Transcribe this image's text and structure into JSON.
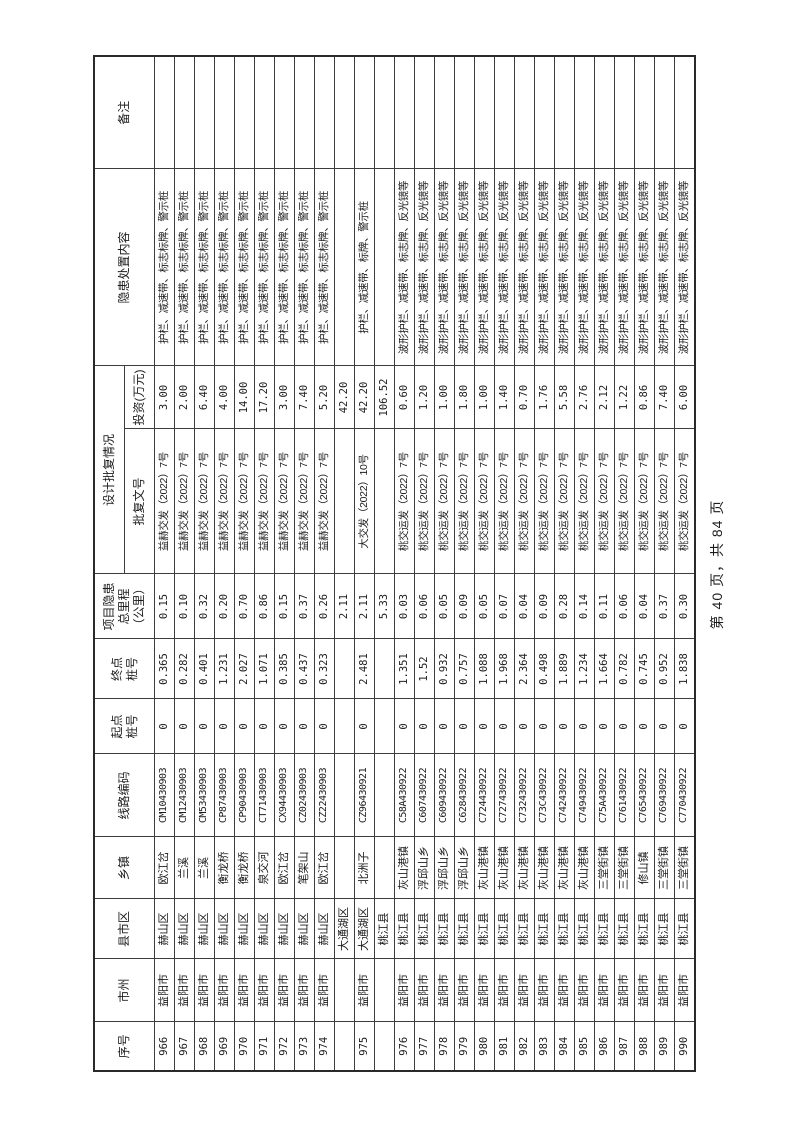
{
  "page": {
    "footer": "第 40 页，共 84 页"
  },
  "table": {
    "group_header": "设计批复情况",
    "columns": [
      {
        "key": "seq",
        "label": "序号"
      },
      {
        "key": "city",
        "label": "市州"
      },
      {
        "key": "county",
        "label": "县市区"
      },
      {
        "key": "town",
        "label": "乡镇"
      },
      {
        "key": "code",
        "label": "线路编码"
      },
      {
        "key": "start",
        "label": "起点\n桩号"
      },
      {
        "key": "end",
        "label": "终点\n桩号"
      },
      {
        "key": "mileage",
        "label": "项目隐患\n总里程\n（公里）"
      },
      {
        "key": "doc",
        "label": "批复文号"
      },
      {
        "key": "invest",
        "label": "投资(万元)"
      },
      {
        "key": "content",
        "label": "隐患处置内容"
      },
      {
        "key": "remark",
        "label": "备注"
      }
    ],
    "rows": [
      [
        "966",
        "益阳市",
        "赫山区",
        "欧江岔",
        "CM10430903",
        "0",
        "0.365",
        "0.15",
        "益赫交发（2022）7号",
        "3.00",
        "护栏、减速带、标志标牌、警示桩",
        ""
      ],
      [
        "967",
        "益阳市",
        "赫山区",
        "兰溪",
        "CM12430903",
        "0",
        "0.282",
        "0.10",
        "益赫交发（2022）7号",
        "2.00",
        "护栏、减速带、标志标牌、警示桩",
        ""
      ],
      [
        "968",
        "益阳市",
        "赫山区",
        "兰溪",
        "CM53430903",
        "0",
        "0.401",
        "0.32",
        "益赫交发（2022）7号",
        "6.40",
        "护栏、减速带、标志标牌、警示桩",
        ""
      ],
      [
        "969",
        "益阳市",
        "赫山区",
        "衡龙桥",
        "CP87430903",
        "0",
        "1.231",
        "0.20",
        "益赫交发（2022）7号",
        "4.00",
        "护栏、减速带、标志标牌、警示桩",
        ""
      ],
      [
        "970",
        "益阳市",
        "赫山区",
        "衡龙桥",
        "CP90430903",
        "0",
        "2.027",
        "0.70",
        "益赫交发（2022）7号",
        "14.00",
        "护栏、减速带、标志标牌、警示桩",
        ""
      ],
      [
        "971",
        "益阳市",
        "赫山区",
        "泉交河",
        "CT71430903",
        "0",
        "1.071",
        "0.86",
        "益赫交发（2022）7号",
        "17.20",
        "护栏、减速带、标志标牌、警示桩",
        ""
      ],
      [
        "972",
        "益阳市",
        "赫山区",
        "欧江岔",
        "CX94430903",
        "0",
        "0.385",
        "0.15",
        "益赫交发（2022）7号",
        "3.00",
        "护栏、减速带、标志标牌、警示桩",
        ""
      ],
      [
        "973",
        "益阳市",
        "赫山区",
        "笔架山",
        "CZ02430903",
        "0",
        "0.437",
        "0.37",
        "益赫交发（2022）7号",
        "7.40",
        "护栏、减速带、标志标牌、警示桩",
        ""
      ],
      [
        "974",
        "益阳市",
        "赫山区",
        "欧江岔",
        "CZ22430903",
        "0",
        "0.323",
        "0.26",
        "益赫交发（2022）7号",
        "5.20",
        "护栏、减速带、标志标牌、警示桩",
        ""
      ],
      [
        "",
        "",
        "大通湖区",
        "",
        "",
        "",
        "",
        "2.11",
        "",
        "42.20",
        "",
        ""
      ],
      [
        "975",
        "益阳市",
        "大通湖区",
        "北洲子",
        "CZ96430921",
        "0",
        "2.481",
        "2.11",
        "大交发（2022）10号",
        "42.20",
        "护栏、减速带、标牌、警示桩",
        ""
      ],
      [
        "",
        "",
        "桃江县",
        "",
        "",
        "",
        "",
        "5.33",
        "",
        "106.52",
        "",
        ""
      ],
      [
        "976",
        "益阳市",
        "桃江县",
        "灰山港镇",
        "C58A430922",
        "0",
        "1.351",
        "0.03",
        "桃交运发（2022）7号",
        "0.60",
        "波形护栏、减速带、标志牌、反光镜等",
        ""
      ],
      [
        "977",
        "益阳市",
        "桃江县",
        "浮邱山乡",
        "C607430922",
        "0",
        "1.52",
        "0.06",
        "桃交运发（2022）7号",
        "1.20",
        "波形护栏、减速带、标志牌、反光镜等",
        ""
      ],
      [
        "978",
        "益阳市",
        "桃江县",
        "浮邱山乡",
        "C609430922",
        "0",
        "0.932",
        "0.05",
        "桃交运发（2022）7号",
        "1.00",
        "波形护栏、减速带、标志牌、反光镜等",
        ""
      ],
      [
        "979",
        "益阳市",
        "桃江县",
        "浮邱山乡",
        "C628430922",
        "0",
        "0.757",
        "0.09",
        "桃交运发（2022）7号",
        "1.80",
        "波形护栏、减速带、标志牌、反光镜等",
        ""
      ],
      [
        "980",
        "益阳市",
        "桃江县",
        "灰山港镇",
        "C724430922",
        "0",
        "1.088",
        "0.05",
        "桃交运发（2022）7号",
        "1.00",
        "波形护栏、减速带、标志牌、反光镜等",
        ""
      ],
      [
        "981",
        "益阳市",
        "桃江县",
        "灰山港镇",
        "C727430922",
        "0",
        "1.968",
        "0.07",
        "桃交运发（2022）7号",
        "1.40",
        "波形护栏、减速带、标志牌、反光镜等",
        ""
      ],
      [
        "982",
        "益阳市",
        "桃江县",
        "灰山港镇",
        "C732430922",
        "0",
        "2.364",
        "0.04",
        "桃交运发（2022）7号",
        "0.70",
        "波形护栏、减速带、标志牌、反光镜等",
        ""
      ],
      [
        "983",
        "益阳市",
        "桃江县",
        "灰山港镇",
        "C73C430922",
        "0",
        "0.498",
        "0.09",
        "桃交运发（2022）7号",
        "1.76",
        "波形护栏、减速带、标志牌、反光镜等",
        ""
      ],
      [
        "984",
        "益阳市",
        "桃江县",
        "灰山港镇",
        "C742430922",
        "0",
        "1.889",
        "0.28",
        "桃交运发（2022）7号",
        "5.58",
        "波形护栏、减速带、标志牌、反光镜等",
        ""
      ],
      [
        "985",
        "益阳市",
        "桃江县",
        "灰山港镇",
        "C749430922",
        "0",
        "1.234",
        "0.14",
        "桃交运发（2022）7号",
        "2.76",
        "波形护栏、减速带、标志牌、反光镜等",
        ""
      ],
      [
        "986",
        "益阳市",
        "桃江县",
        "三堂街镇",
        "C75A430922",
        "0",
        "1.664",
        "0.11",
        "桃交运发（2022）7号",
        "2.12",
        "波形护栏、减速带、标志牌、反光镜等",
        ""
      ],
      [
        "987",
        "益阳市",
        "桃江县",
        "三堂街镇",
        "C761430922",
        "0",
        "0.782",
        "0.06",
        "桃交运发（2022）7号",
        "1.22",
        "波形护栏、减速带、标志牌、反光镜等",
        ""
      ],
      [
        "988",
        "益阳市",
        "桃江县",
        "修山镇",
        "C765430922",
        "0",
        "0.745",
        "0.04",
        "桃交运发（2022）7号",
        "0.86",
        "波形护栏、减速带、标志牌、反光镜等",
        ""
      ],
      [
        "989",
        "益阳市",
        "桃江县",
        "三堂街镇",
        "C769430922",
        "0",
        "0.952",
        "0.37",
        "桃交运发（2022）7号",
        "7.40",
        "波形护栏、减速带、标志牌、反光镜等",
        ""
      ],
      [
        "990",
        "益阳市",
        "桃江县",
        "三堂街镇",
        "C770430922",
        "0",
        "1.838",
        "0.30",
        "桃交运发（2022）7号",
        "6.00",
        "波形护栏、减速带、标志牌、反光镜等",
        ""
      ]
    ]
  }
}
